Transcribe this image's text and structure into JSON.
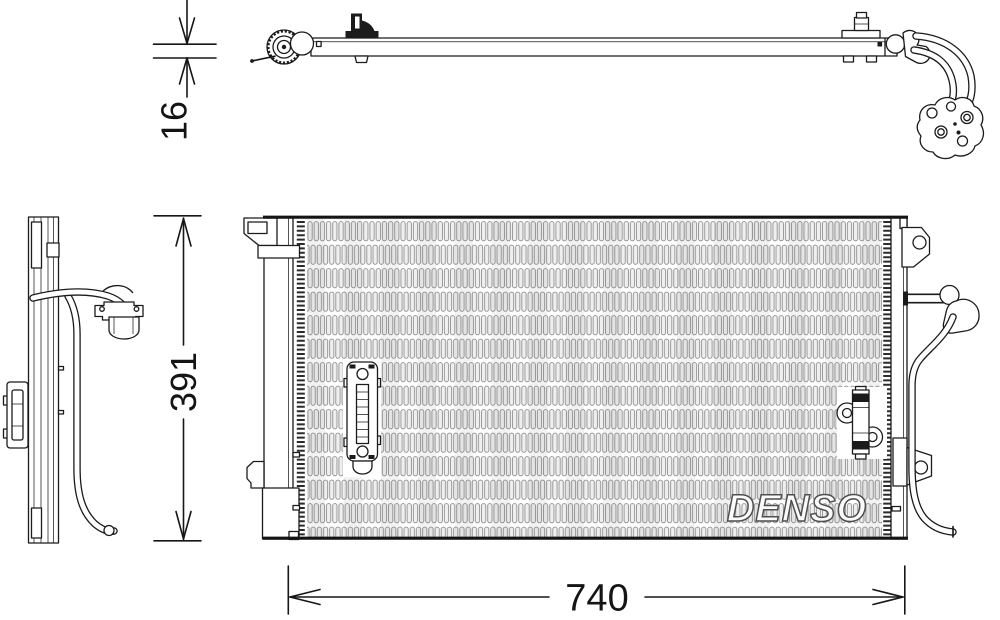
{
  "labels": {
    "brand": "DENSO",
    "dim_depth": "16",
    "dim_height": "391",
    "dim_width": "740"
  },
  "colors": {
    "background": "#ffffff",
    "line": "#1b1b1b",
    "fin_stroke": "#8e8e8e",
    "watermark_fill": "#fbfbfb",
    "watermark_outline": "#4f4f4f"
  }
}
